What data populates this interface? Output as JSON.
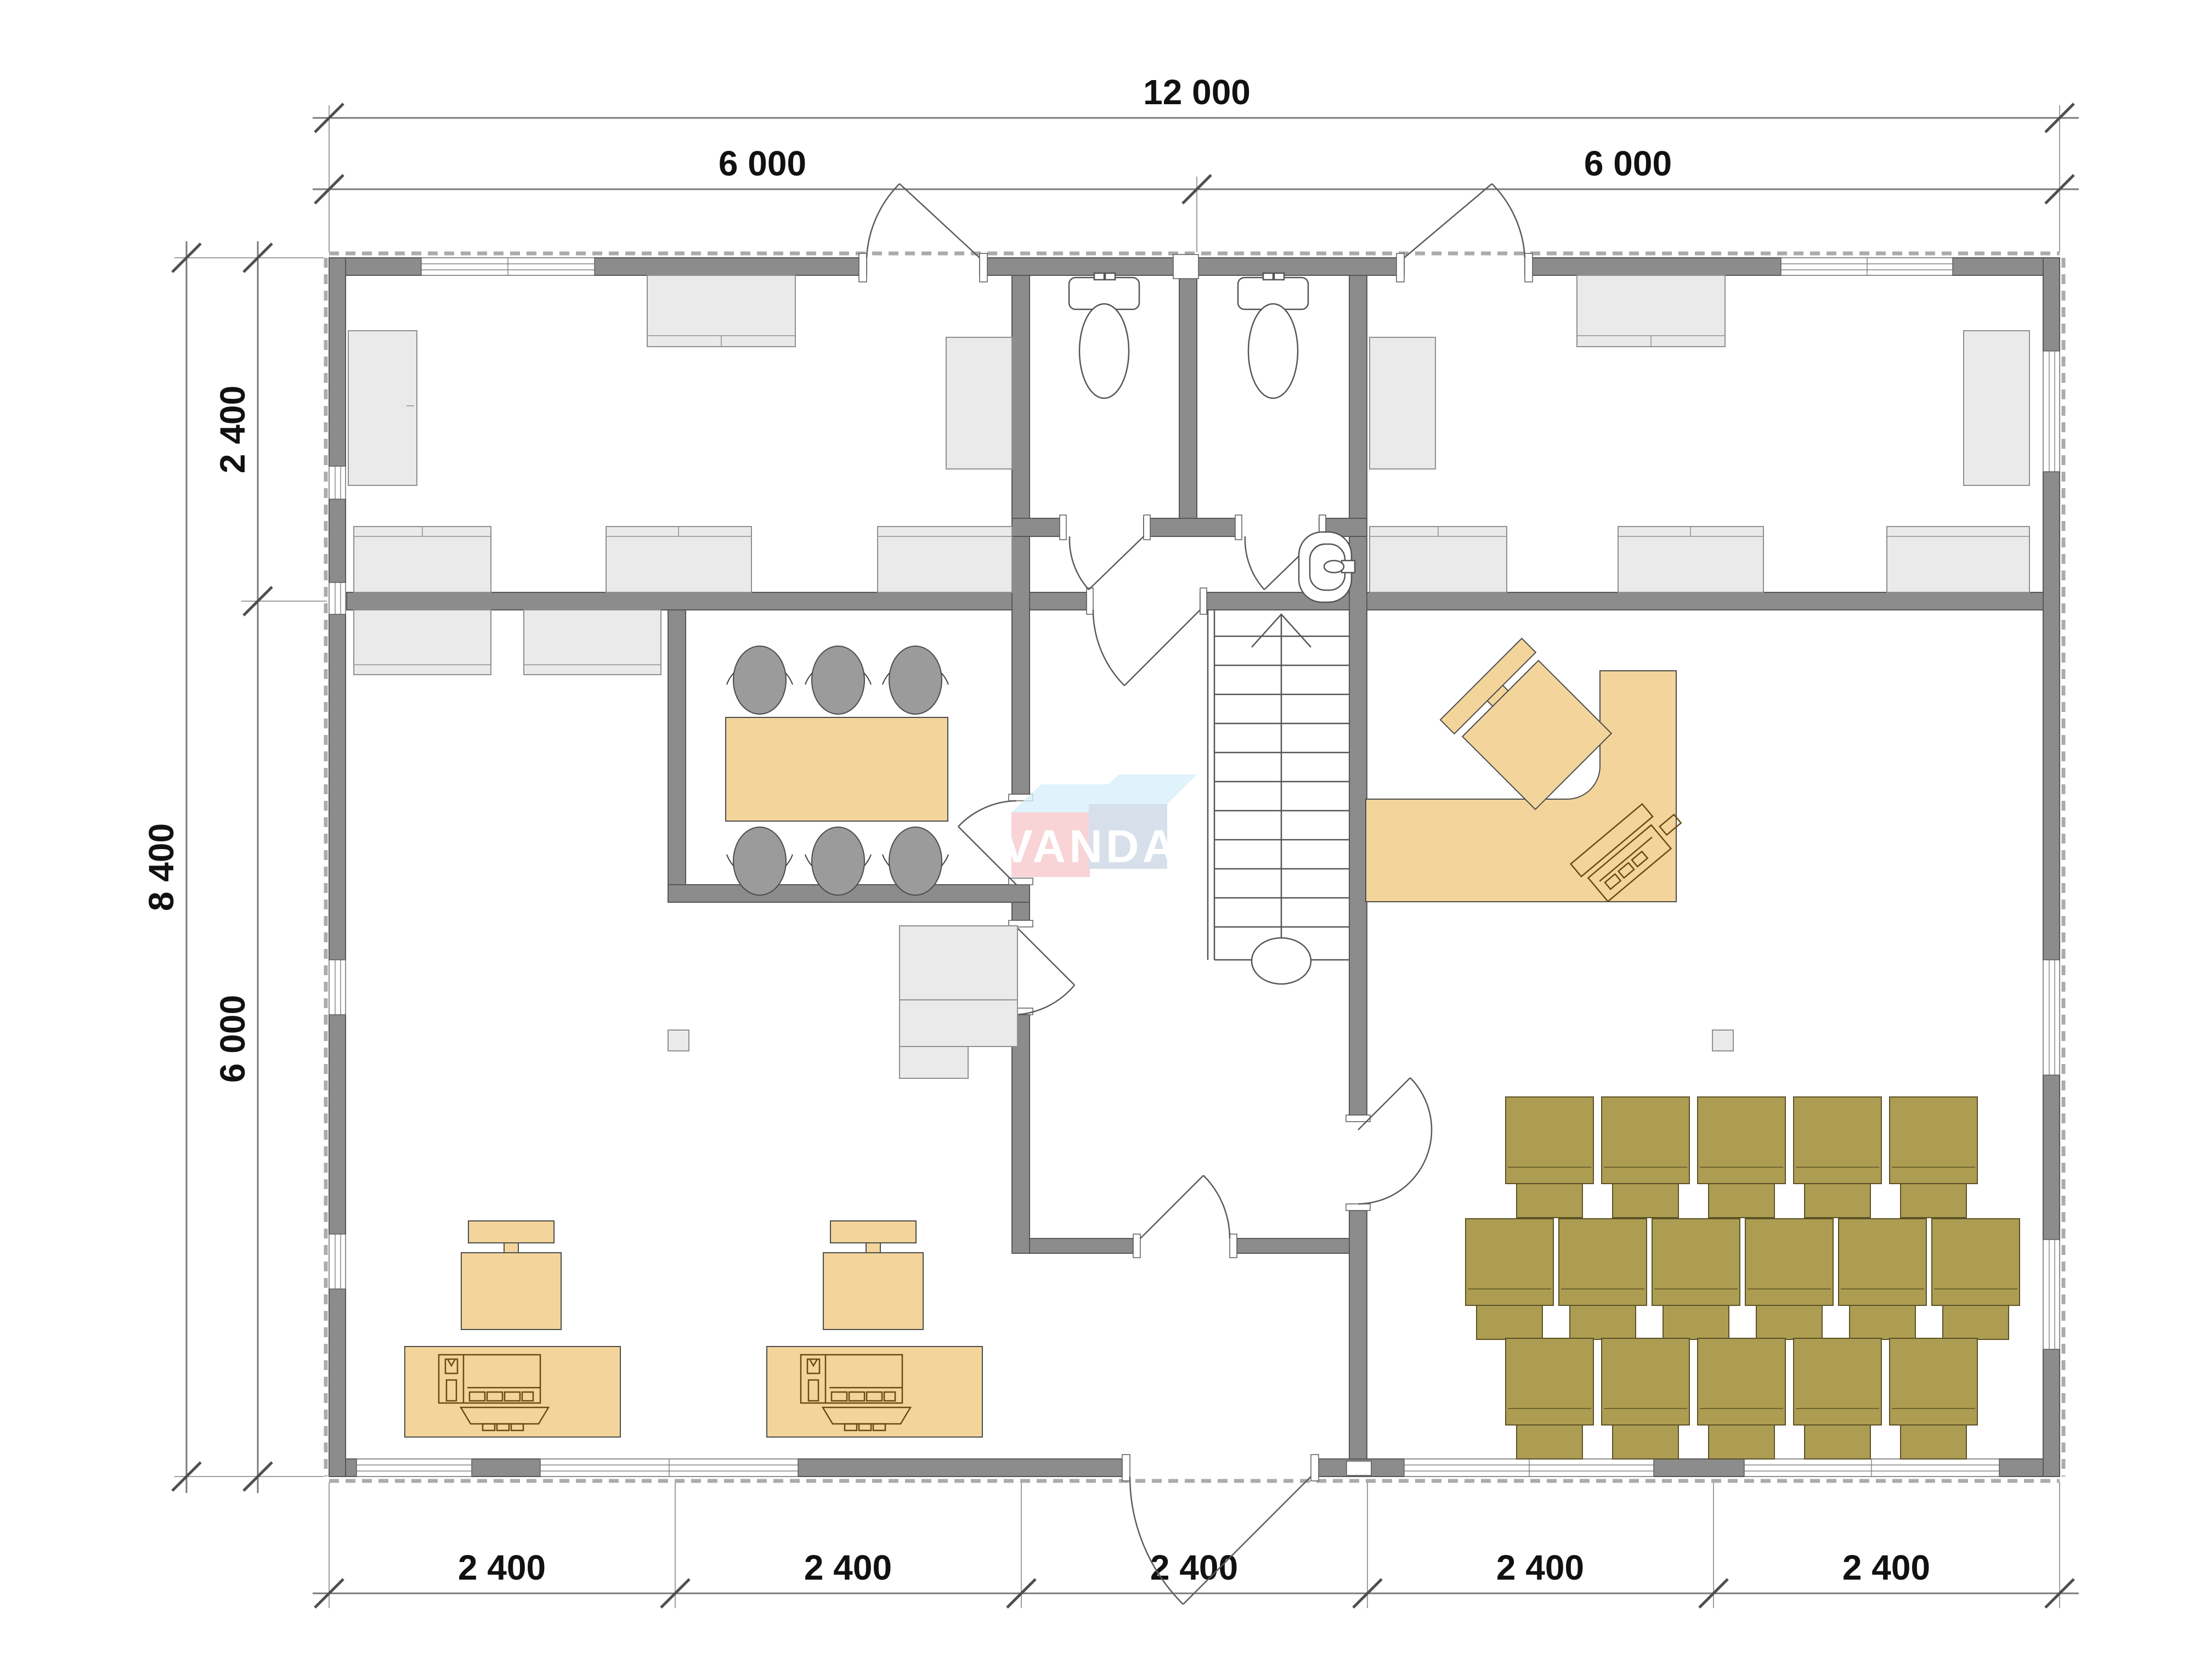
{
  "watermark": {
    "text": "VANDA"
  },
  "dimensions": {
    "top_total": "12 000",
    "top_left": "6 000",
    "top_right": "6 000",
    "left_upper": "2 400",
    "left_total": "8 400",
    "left_lower": "6 000",
    "bottom": [
      "2 400",
      "2 400",
      "2 400",
      "2 400",
      "2 400"
    ]
  },
  "colors": {
    "wall_gray": "#8c8c8c",
    "furniture_gray": "#eaeaea",
    "desk_tan": "#f3d59b",
    "classroom_olive": "#ac9d52",
    "dimension_text": "#111111",
    "logo_pink": "#f7c9cd",
    "logo_blue_gray": "#ccd7e5",
    "logo_sky_blue": "#d8effa"
  }
}
